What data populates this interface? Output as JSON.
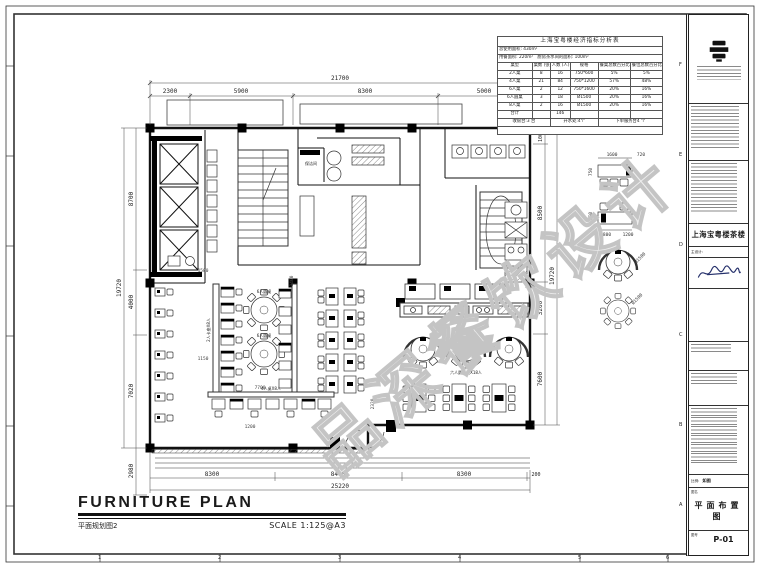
{
  "watermark": {
    "text": "品深餐饮设计"
  },
  "econ": {
    "title": "上海宝粤楼经济指标分析表",
    "info1": "总使用面积: 430m²",
    "info2": "用餐面积: 220m²　厨房茶水间的面积: 100m²",
    "headers": [
      "桌型",
      "桌数 (张)",
      "人数 (人)",
      "规格",
      "餐桌总数百分比",
      "餐位总数百分比"
    ],
    "rows": [
      [
        "2人桌",
        "8",
        "16",
        "750*600",
        "5%",
        "5%"
      ],
      [
        "4人桌",
        "21",
        "84",
        "750*1200",
        "57%",
        "48%"
      ],
      [
        "6人桌",
        "2",
        "12",
        "750*1600",
        "20%",
        "16%"
      ],
      [
        "6人圆桌",
        "3",
        "18",
        "Ø1500",
        "20%",
        "16%"
      ],
      [
        "8人桌",
        "2",
        "16",
        "Ø1500",
        "20%",
        "16%"
      ]
    ],
    "total_label": "合计",
    "total_people": "146",
    "footer": [
      "收银台:3 台",
      "开水处:4个",
      "下单服务台4 个"
    ]
  },
  "title_block": {
    "project_name": "上海宝粤楼茶楼",
    "designer_label": "主设计:",
    "scale_label": "比例:",
    "scale_value": "如图",
    "name_label": "图名",
    "drawing_name": "平面布置图",
    "no_label": "图号",
    "drawing_no": "P-01"
  },
  "footer": {
    "title": "FURNITURE PLAN",
    "subtitle": "平面规划图2",
    "scale": "SCALE  1:125@A3"
  },
  "frame": {
    "row_letters": [
      "F",
      "E",
      "D",
      "C",
      "B",
      "A"
    ],
    "col_numbers": [
      "1",
      "2",
      "3",
      "4",
      "5",
      "6"
    ]
  },
  "plan": {
    "labels": {
      "clean_room": "保洁间",
      "round_table_a": "6人圆桌",
      "round_table_b": "6人圆桌",
      "arc_booth_row": "六人圆卡桌X18人",
      "four_top_row": "4人桌X8人",
      "booth_left": "2人卡座X8人"
    },
    "dims": {
      "top_total": "21700",
      "top": [
        "2300",
        "5900",
        "8300",
        "5000"
      ],
      "left": [
        "8700",
        "4000",
        "7020"
      ],
      "left_total": "19720",
      "left_extra": "2980",
      "right": [
        "1000",
        "8500",
        "3200",
        "7600"
      ],
      "right_total": "19720",
      "bottom": [
        "8300",
        "8400",
        "8300",
        "200"
      ],
      "bottom_total": "25220",
      "inner": [
        "1500",
        "1150",
        "1400",
        "7700",
        "1200",
        "2320"
      ],
      "details": [
        "1600",
        "720",
        "800",
        "1200",
        "Ø1500",
        "Ø1500",
        "750",
        "250"
      ]
    }
  }
}
